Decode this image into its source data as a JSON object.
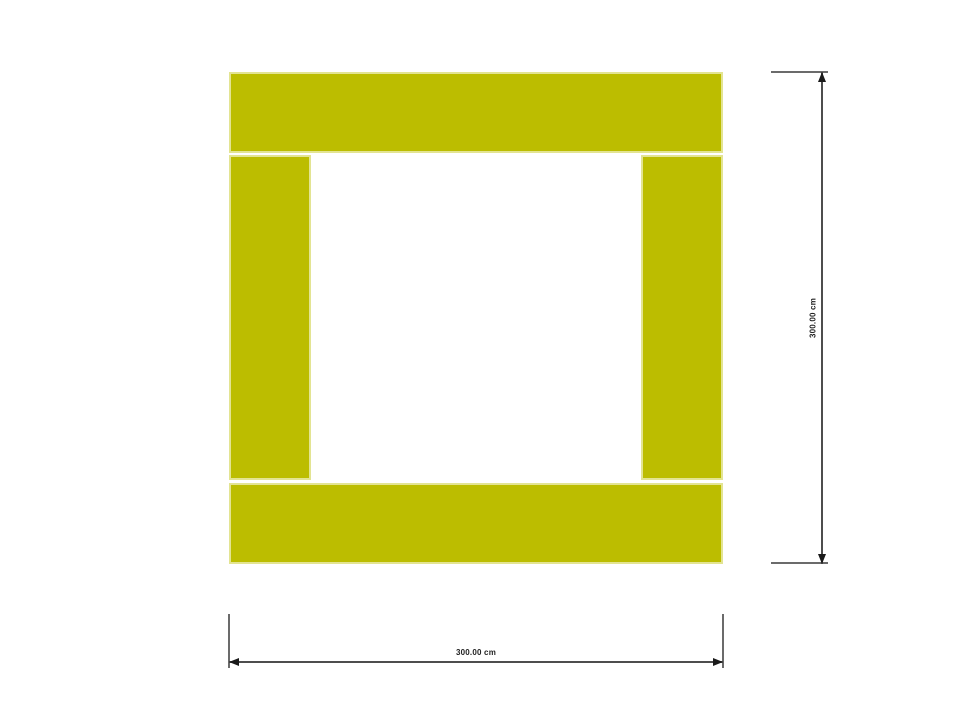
{
  "plan": {
    "description": "Square floor plan made of four wall segments with an open interior",
    "wall_fill_color": "#bcbd00",
    "wall_stroke_color": "#e3e492",
    "background_color": "#ffffff",
    "walls": [
      {
        "id": "wall-top"
      },
      {
        "id": "wall-left"
      },
      {
        "id": "wall-right"
      },
      {
        "id": "wall-bottom"
      }
    ]
  },
  "dimensions": {
    "line_color": "#4d4d4d",
    "extension_line_color": "#6b6b6b",
    "arrow_color": "#1a1a1a",
    "text_color": "#222222",
    "horizontal": {
      "label": "300.00 cm"
    },
    "vertical": {
      "label": "300.00 cm"
    }
  }
}
